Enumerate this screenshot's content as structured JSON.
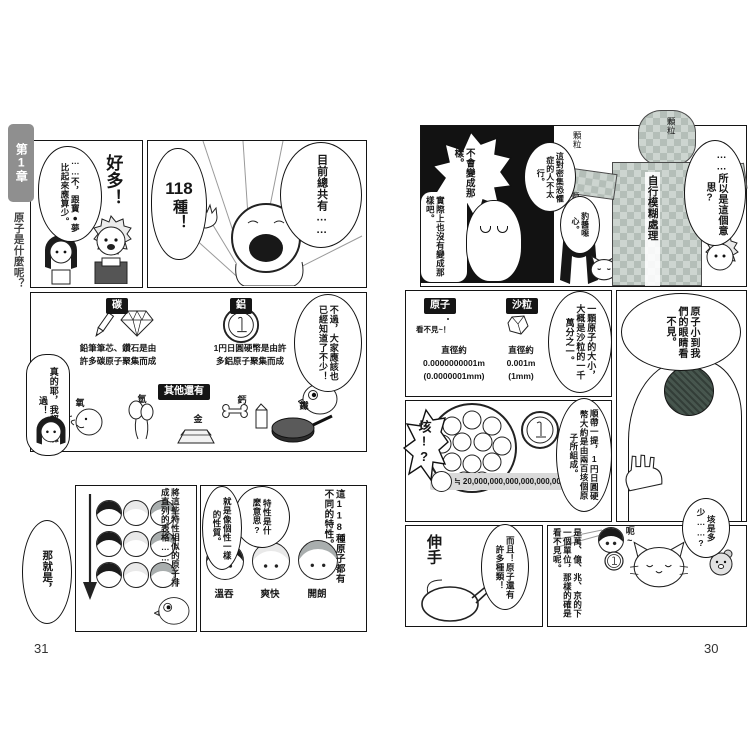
{
  "book": {
    "chapter_tab": "第1章",
    "chapter_title": "原子是什麼呢？",
    "left_page_number": "31",
    "right_page_number": "30"
  },
  "left_page": {
    "panel_count": {
      "bubble": "目前總共有……",
      "burst_number": "118",
      "burst_unit": "種！"
    },
    "panel_react": {
      "shout": "好多！",
      "reply": "……不，跟寶●夢比起來應算少。"
    },
    "panel_examples": {
      "carbon_label": "碳",
      "carbon_caption_1": "鉛筆筆芯、鑽石是由",
      "carbon_caption_2": "許多碳原子聚集而成",
      "aluminum_label": "鋁",
      "aluminum_caption_1": "1円日圓硬幣是由許",
      "aluminum_caption_2": "多鋁原子聚集而成",
      "more_header": "其他還有",
      "items": [
        {
          "label": "氧",
          "icon": "breath-icon"
        },
        {
          "label": "氫",
          "icon": "balloons-icon"
        },
        {
          "label": "金",
          "icon": "gold-bar-icon"
        },
        {
          "label": "鈣",
          "icon": "bone-and-milk-icon"
        },
        {
          "label": "鐵",
          "icon": "frying-pan-icon"
        }
      ],
      "bubble_known": "不過，大家應該也已經知道了不少！",
      "bubble_heard": "真的耶，我都有聽過！"
    },
    "panel_traits": {
      "narration": "這118種原子都有不同的特性。",
      "question": "特性是什麼意思?",
      "answer": "就是像個性一樣的性質。",
      "trait_labels": [
        "溫吞",
        "爽快",
        "開朗"
      ]
    },
    "panel_table": {
      "narration": "將這些特性相似的原子排成直列的表格……",
      "lead_out": "那就是，"
    }
  },
  "right_page": {
    "panel_mosaic": {
      "mosaic_label": "自行模糊處理",
      "grain_label": "顆粒",
      "burst": "不會變成那樣。",
      "ghost_line": "實際上也沒有變成那樣吧。",
      "trypophobia_line": "這對密集恐懼症的人不太行。",
      "gross_line": "豹醬噁心。",
      "meaning_line": "……所以是這個意思?"
    },
    "panel_size": {
      "atom_label": "原子",
      "atom_note": "看不見~！",
      "atom_d1": "直徑約",
      "atom_d2": "0.0000000001m",
      "atom_d3": "(0.0000001mm)",
      "sand_label": "沙粒",
      "sand_d1": "直徑約",
      "sand_d2": "0.001m",
      "sand_d3": "(1mm)",
      "comparison": "一顆原子的大小，大概是沙粒的一千萬分之一。"
    },
    "panel_invisible": {
      "bubble": "原子小到我們的眼睛看不見。"
    },
    "panel_coin": {
      "exclaim": "垓!?",
      "bubble": "順帶一提，1円日圓硬幣大約是由兩百垓個原子所組成。",
      "count_text": "≒ 20,000,000,000,000,000,000,000個"
    },
    "panel_reach": {
      "sfx": "伸手",
      "bubble": "而且！原子還有許多種類！"
    },
    "panel_gai": {
      "question": "垓是多少……?",
      "reply": "呃~",
      "explanation": "是萬、億、兆、京的下一個單位，那樣的確是看不見呢。"
    }
  },
  "colors": {
    "ink": "#141414",
    "label_bg": "#151515",
    "mosaic_light": "#cdd5d0",
    "mosaic_dark": "#b4beb8",
    "bar_bg": "#d9d9d9",
    "tab_bg": "#8f8f8f"
  }
}
